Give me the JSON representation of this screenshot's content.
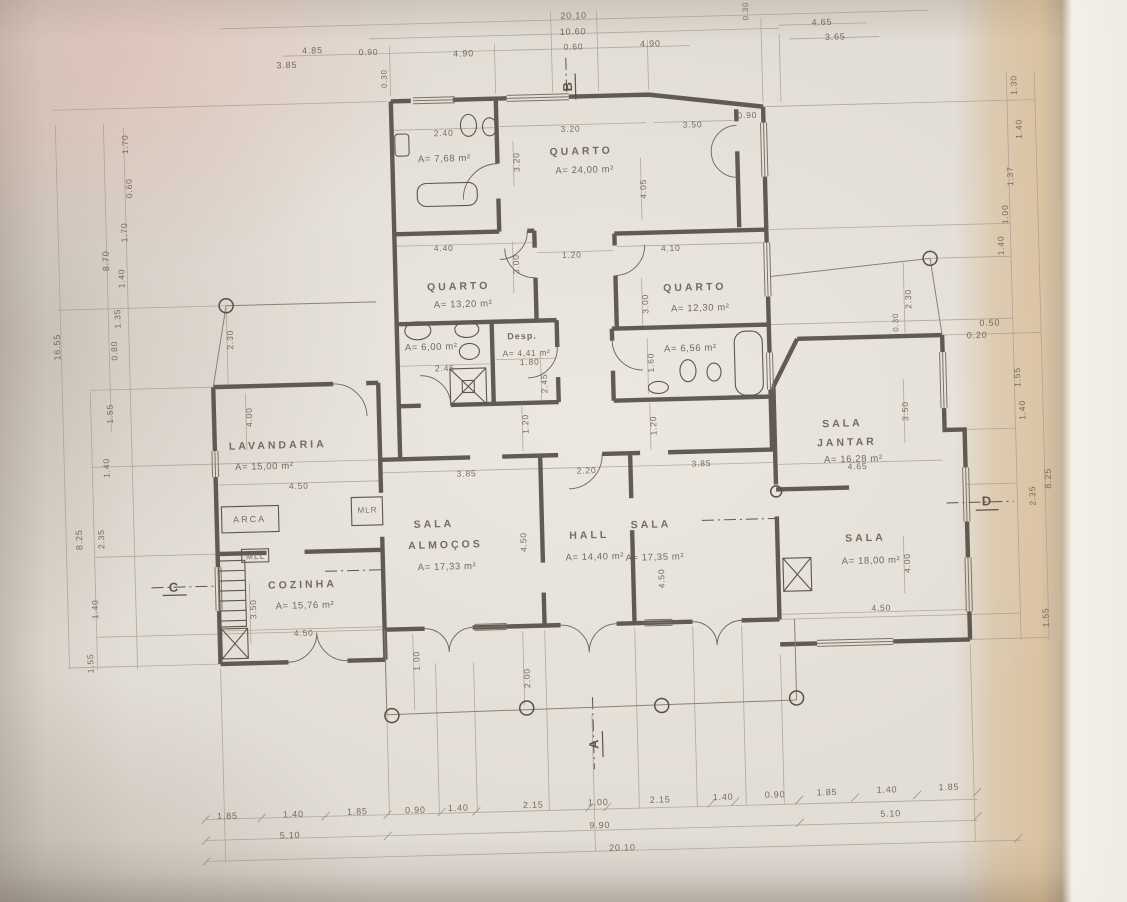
{
  "drawing": {
    "type_hint": "hand-drafted residential floor plan, scanned photo",
    "colors": {
      "paper": "#e2ddd5",
      "tint_band": "#d2a262",
      "pink_glow": "#d8a396",
      "ink": "#5f574a",
      "dim_ink": "#6b6355",
      "wall": "#4e4840"
    }
  },
  "plan": {
    "rooms": [
      {
        "id": "quarto-principal",
        "label": "QUARTO",
        "area": "A= 24,00 m²",
        "lx": 589,
        "ly": 152,
        "ax": 592,
        "ay": 171
      },
      {
        "id": "wc-principal",
        "area": "A= 7,68 m²",
        "ax": 452,
        "ay": 156
      },
      {
        "id": "quarto-2",
        "label": "QUARTO",
        "area": "A= 13,20 m²",
        "lx": 463,
        "ly": 284,
        "ax": 467,
        "ay": 302
      },
      {
        "id": "quarto-3",
        "label": "QUARTO",
        "area": "A= 12,30 m²",
        "lx": 699,
        "ly": 291,
        "ax": 704,
        "ay": 312
      },
      {
        "id": "wc-2",
        "area": "A= 6,00 m²",
        "ax": 434,
        "ay": 344
      },
      {
        "id": "despensa",
        "label": "Desp.",
        "area": "A= 4,41 m²",
        "lx": 525,
        "ly": 335,
        "ax": 529,
        "ay": 352,
        "small": true
      },
      {
        "id": "wc-3",
        "area": "A= 6,56 m²",
        "ax": 693,
        "ay": 352
      },
      {
        "id": "lavandaria",
        "label": "LAVANDARIA",
        "area": "A= 15,00 m²",
        "lx": 278,
        "ly": 438,
        "ax": 264,
        "ay": 459
      },
      {
        "id": "sala-almocos",
        "label": "SALA",
        "label2": "ALMOÇOS",
        "area": "A= 17,33 m²",
        "lx": 432,
        "ly": 521,
        "l2x": 443,
        "l2y": 542,
        "ax": 444,
        "ay": 564
      },
      {
        "id": "hall",
        "label": "HALL",
        "area": "A= 14,40 m²",
        "lx": 587,
        "ly": 536,
        "ax": 592,
        "ay": 558
      },
      {
        "id": "sala",
        "label": "SALA",
        "area": "A= 17,35 m²",
        "lx": 649,
        "ly": 527,
        "ax": 652,
        "ay": 560
      },
      {
        "id": "sala-jantar",
        "label": "SALA",
        "label2": "JANTAR",
        "area": "A= 16,28 m²",
        "lx": 843,
        "ly": 431,
        "l2x": 847,
        "l2y": 450,
        "ax": 853,
        "ay": 467
      },
      {
        "id": "sala-2",
        "label": "SALA",
        "area": "A= 18,00 m²",
        "lx": 863,
        "ly": 546,
        "ax": 868,
        "ay": 569
      },
      {
        "id": "cozinha",
        "label": "COZINHA",
        "area": "A= 15,76 m²",
        "lx": 299,
        "ly": 578,
        "ax": 301,
        "ay": 599
      }
    ],
    "annotations": [
      {
        "name": "dim-top-total",
        "t": "20.10",
        "x": 585,
        "y": 16,
        "s": 9
      },
      {
        "name": "dim-top",
        "t": "10.60",
        "x": 584,
        "y": 32,
        "s": 9
      },
      {
        "name": "dim-top",
        "t": "0.60",
        "x": 584,
        "y": 47,
        "s": 8.5
      },
      {
        "name": "dim-top",
        "t": "4.85",
        "x": 323,
        "y": 44,
        "s": 9
      },
      {
        "name": "dim-top",
        "t": "3.85",
        "x": 297,
        "y": 58,
        "s": 9
      },
      {
        "name": "dim-top",
        "t": "0.90",
        "x": 379,
        "y": 47,
        "s": 8.5
      },
      {
        "name": "dim-top",
        "t": "4.90",
        "x": 474,
        "y": 51,
        "s": 9
      },
      {
        "name": "dim-top",
        "t": "4.90",
        "x": 661,
        "y": 46,
        "s": 9
      },
      {
        "name": "dim-top",
        "t": "4.65",
        "x": 833,
        "y": 29,
        "s": 9
      },
      {
        "name": "dim-top",
        "t": "3.65",
        "x": 846,
        "y": 44,
        "s": 9
      },
      {
        "name": "dim-top",
        "t": "0.30",
        "x": 757,
        "y": 16,
        "r": -90,
        "s": 8
      },
      {
        "name": "dim-top",
        "t": "0.30",
        "x": 394,
        "y": 74,
        "r": -90,
        "s": 8
      },
      {
        "name": "dim-bottom",
        "t": "1.85",
        "x": 218,
        "y": 807,
        "s": 9
      },
      {
        "name": "dim-bottom",
        "t": "1.40",
        "x": 284,
        "y": 807,
        "s": 9
      },
      {
        "name": "dim-bottom",
        "t": "1.85",
        "x": 348,
        "y": 806,
        "s": 9
      },
      {
        "name": "dim-bottom",
        "t": "0.90",
        "x": 406,
        "y": 806,
        "s": 9
      },
      {
        "name": "dim-bottom",
        "t": "1.40",
        "x": 449,
        "y": 805,
        "s": 9
      },
      {
        "name": "dim-bottom",
        "t": "2.15",
        "x": 524,
        "y": 804,
        "s": 9
      },
      {
        "name": "dim-bottom",
        "t": "1.00",
        "x": 589,
        "y": 803,
        "s": 9
      },
      {
        "name": "dim-bottom",
        "t": "2.15",
        "x": 651,
        "y": 802,
        "s": 9
      },
      {
        "name": "dim-bottom",
        "t": "1.40",
        "x": 714,
        "y": 801,
        "s": 9
      },
      {
        "name": "dim-bottom",
        "t": "0.90",
        "x": 766,
        "y": 800,
        "s": 9
      },
      {
        "name": "dim-bottom",
        "t": "1.85",
        "x": 818,
        "y": 799,
        "s": 9
      },
      {
        "name": "dim-bottom",
        "t": "1.40",
        "x": 878,
        "y": 798,
        "s": 9
      },
      {
        "name": "dim-bottom",
        "t": "1.85",
        "x": 940,
        "y": 797,
        "s": 9
      },
      {
        "name": "dim-bottom",
        "t": "5.10",
        "x": 280,
        "y": 828,
        "s": 9
      },
      {
        "name": "dim-bottom",
        "t": "9.90",
        "x": 590,
        "y": 826,
        "s": 9
      },
      {
        "name": "dim-bottom",
        "t": "5.10",
        "x": 881,
        "y": 822,
        "s": 9
      },
      {
        "name": "dim-bottom-total",
        "t": "20.10",
        "x": 612,
        "y": 849,
        "s": 9
      },
      {
        "name": "dim-left-total",
        "t": "16.55",
        "x": 60,
        "y": 334,
        "r": -90,
        "s": 9
      },
      {
        "name": "dim-left",
        "t": "8.70",
        "x": 111,
        "y": 249,
        "r": -90,
        "s": 9
      },
      {
        "name": "dim-left",
        "t": "1.70",
        "x": 133,
        "y": 133,
        "r": -90,
        "s": 8.5
      },
      {
        "name": "dim-left",
        "t": "0.60",
        "x": 136,
        "y": 177,
        "r": -90,
        "s": 8.5
      },
      {
        "name": "dim-left",
        "t": "1.70",
        "x": 130,
        "y": 221,
        "r": -90,
        "s": 8.5
      },
      {
        "name": "dim-left",
        "t": "1.40",
        "x": 126,
        "y": 267,
        "r": -90,
        "s": 8.5
      },
      {
        "name": "dim-left",
        "t": "1.35",
        "x": 121,
        "y": 307,
        "r": -90,
        "s": 8.5
      },
      {
        "name": "dim-left",
        "t": "0.80",
        "x": 117,
        "y": 339,
        "r": -90,
        "s": 8.5
      },
      {
        "name": "dim-left",
        "t": "1.55",
        "x": 111,
        "y": 402,
        "r": -90,
        "s": 8.5
      },
      {
        "name": "dim-left",
        "t": "1.40",
        "x": 106,
        "y": 456,
        "r": -90,
        "s": 8.5
      },
      {
        "name": "dim-left",
        "t": "2.35",
        "x": 99,
        "y": 527,
        "r": -90,
        "s": 8.5
      },
      {
        "name": "dim-left",
        "t": "8.25",
        "x": 77,
        "y": 527,
        "r": -90,
        "s": 9
      },
      {
        "name": "dim-left",
        "t": "1.40",
        "x": 91,
        "y": 597,
        "r": -90,
        "s": 8.5
      },
      {
        "name": "dim-left",
        "t": "1.55",
        "x": 85,
        "y": 651,
        "r": -90,
        "s": 8.5
      },
      {
        "name": "dim-right",
        "t": "1.30",
        "x": 1023,
        "y": 97,
        "r": -90,
        "s": 8.5
      },
      {
        "name": "dim-right",
        "t": "1.40",
        "x": 1027,
        "y": 141,
        "r": -90,
        "s": 8.5
      },
      {
        "name": "dim-right",
        "t": "1.37",
        "x": 1017,
        "y": 188,
        "r": -90,
        "s": 8.5
      },
      {
        "name": "dim-right",
        "t": "1.00",
        "x": 1011,
        "y": 226,
        "r": -90,
        "s": 8.5
      },
      {
        "name": "dim-right",
        "t": "1.40",
        "x": 1006,
        "y": 257,
        "r": -90,
        "s": 8.5
      },
      {
        "name": "dim-right",
        "t": "1.55",
        "x": 1019,
        "y": 389,
        "r": -90,
        "s": 8.5
      },
      {
        "name": "dim-right",
        "t": "1.40",
        "x": 1023,
        "y": 422,
        "r": -90,
        "s": 8.5
      },
      {
        "name": "dim-right",
        "t": "2.35",
        "x": 1031,
        "y": 508,
        "r": -90,
        "s": 8.5
      },
      {
        "name": "dim-right",
        "t": "8.25",
        "x": 1047,
        "y": 491,
        "r": -90,
        "s": 9
      },
      {
        "name": "dim-right",
        "t": "1.55",
        "x": 1041,
        "y": 630,
        "r": -90,
        "s": 8.5
      },
      {
        "name": "dim-right",
        "t": "0.50",
        "x": 993,
        "y": 334,
        "s": 9
      },
      {
        "name": "dim-right",
        "t": "0.20",
        "x": 980,
        "y": 346,
        "s": 9
      },
      {
        "name": "dim-right",
        "t": "2.30",
        "x": 912,
        "y": 308,
        "r": -90,
        "s": 8.5
      },
      {
        "name": "dim-right",
        "t": "0.30",
        "x": 899,
        "y": 331,
        "r": -90,
        "s": 8
      },
      {
        "name": "dim-int",
        "t": "2.40",
        "x": 452,
        "y": 130,
        "s": 8.5
      },
      {
        "name": "dim-int",
        "t": "3.20",
        "x": 579,
        "y": 129,
        "s": 8.5
      },
      {
        "name": "dim-int",
        "t": "3.20",
        "x": 524,
        "y": 161,
        "r": -90,
        "s": 8.5
      },
      {
        "name": "dim-int",
        "t": "4.05",
        "x": 650,
        "y": 191,
        "r": -90,
        "s": 8.5
      },
      {
        "name": "dim-int",
        "t": "3.50",
        "x": 701,
        "y": 128,
        "s": 8.5
      },
      {
        "name": "dim-int",
        "t": "0.90",
        "x": 756,
        "y": 120,
        "s": 8.5
      },
      {
        "name": "dim-int",
        "t": "4.40",
        "x": 449,
        "y": 245,
        "s": 8.5
      },
      {
        "name": "dim-int",
        "t": "3.00",
        "x": 521,
        "y": 263,
        "r": -90,
        "s": 8.5
      },
      {
        "name": "dim-int",
        "t": "1.20",
        "x": 577,
        "y": 255,
        "s": 8.5
      },
      {
        "name": "dim-int",
        "t": "4.10",
        "x": 676,
        "y": 251,
        "s": 8.5
      },
      {
        "name": "dim-int",
        "t": "3.00",
        "x": 649,
        "y": 306,
        "r": -90,
        "s": 8.5
      },
      {
        "name": "dim-int",
        "t": "2.45",
        "x": 447,
        "y": 365,
        "s": 8.5
      },
      {
        "name": "dim-int",
        "t": "1.80",
        "x": 532,
        "y": 361,
        "s": 8.5
      },
      {
        "name": "dim-int",
        "t": "2.45",
        "x": 546,
        "y": 383,
        "r": -90,
        "s": 8.5
      },
      {
        "name": "dim-int",
        "t": "1.60",
        "x": 653,
        "y": 365,
        "r": -90,
        "s": 8.5
      },
      {
        "name": "dim-int",
        "t": "1.20",
        "x": 526,
        "y": 423,
        "r": -90,
        "s": 8.5
      },
      {
        "name": "dim-int",
        "t": "1.20",
        "x": 654,
        "y": 428,
        "r": -90,
        "s": 8.5
      },
      {
        "name": "dim-int",
        "t": "2.30",
        "x": 233,
        "y": 331,
        "r": -90,
        "s": 8.5
      },
      {
        "name": "dim-int",
        "t": "4.00",
        "x": 250,
        "y": 409,
        "r": -90,
        "s": 8.5
      },
      {
        "name": "dim-int",
        "t": "4.50",
        "x": 298,
        "y": 479,
        "s": 8.5
      },
      {
        "name": "dim-int",
        "t": "3.85",
        "x": 466,
        "y": 471,
        "s": 8.5
      },
      {
        "name": "dim-int",
        "t": "2.20",
        "x": 586,
        "y": 471,
        "s": 8.5
      },
      {
        "name": "dim-int",
        "t": "3.85",
        "x": 701,
        "y": 467,
        "s": 8.5
      },
      {
        "name": "dim-int",
        "t": "4.50",
        "x": 521,
        "y": 541,
        "r": -90,
        "s": 8.5
      },
      {
        "name": "dim-int",
        "t": "4.50",
        "x": 658,
        "y": 581,
        "r": -90,
        "s": 8.5
      },
      {
        "name": "dim-int",
        "t": "4.65",
        "x": 857,
        "y": 474,
        "s": 8.5
      },
      {
        "name": "dim-int",
        "t": "3.50",
        "x": 906,
        "y": 420,
        "r": -90,
        "s": 8.5
      },
      {
        "name": "dim-int",
        "t": "4.00",
        "x": 904,
        "y": 572,
        "r": -90,
        "s": 8.5
      },
      {
        "name": "dim-int",
        "t": "4.50",
        "x": 877,
        "y": 616,
        "s": 8.5
      },
      {
        "name": "dim-int",
        "t": "3.50",
        "x": 249,
        "y": 601,
        "r": -90,
        "s": 8.5
      },
      {
        "name": "dim-int",
        "t": "4.50",
        "x": 299,
        "y": 626,
        "s": 8.5
      },
      {
        "name": "dim-int",
        "t": "1.00",
        "x": 411,
        "y": 657,
        "r": -90,
        "s": 8.5
      },
      {
        "name": "dim-int",
        "t": "2.00",
        "x": 521,
        "y": 677,
        "r": -90,
        "s": 8.5
      },
      {
        "name": "equip-arca",
        "t": "ARCA",
        "x": 248,
        "y": 511,
        "s": 9,
        "ls": 2
      },
      {
        "name": "equip-mlr",
        "t": "MLR",
        "x": 366,
        "y": 505,
        "s": 8,
        "ls": 1
      },
      {
        "name": "equip-mll",
        "t": "MLL",
        "x": 253,
        "y": 548,
        "s": 8.5,
        "ls": 1
      },
      {
        "name": "section-marker-a",
        "t": "A",
        "x": 586,
        "y": 745,
        "r": -90,
        "s": 13,
        "cls": "marker"
      },
      {
        "name": "section-marker-b",
        "t": "B",
        "x": 577,
        "y": 87,
        "r": -90,
        "s": 13,
        "cls": "marker"
      },
      {
        "name": "section-marker-c",
        "t": "C",
        "x": 170,
        "y": 577,
        "s": 13,
        "cls": "marker"
      },
      {
        "name": "section-marker-d",
        "t": "D",
        "x": 985,
        "y": 512,
        "s": 13,
        "cls": "marker"
      }
    ]
  }
}
